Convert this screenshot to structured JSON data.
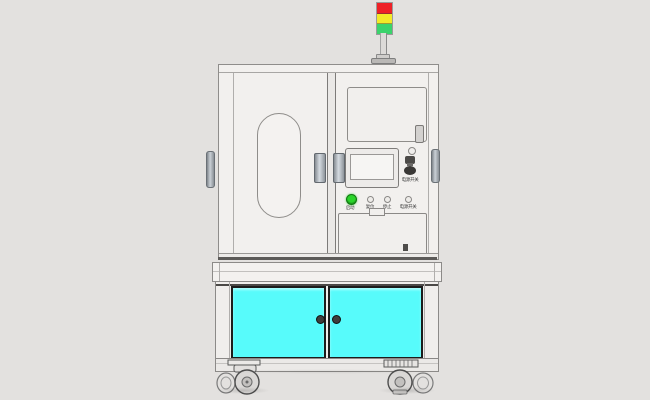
{
  "scene": {
    "background_color": "#e3e1df",
    "body_color": "#f2f0ee",
    "outline_color": "#8f8d8b"
  },
  "tower_light": {
    "segments": [
      {
        "name": "red-lamp",
        "color": "#ee2127"
      },
      {
        "name": "yellow-lamp",
        "color": "#f3ea27"
      },
      {
        "name": "green-lamp",
        "color": "#3bd36c"
      }
    ]
  },
  "control_panel": {
    "estop_label": "电源开关",
    "buttons": [
      {
        "label": "启动",
        "color": "#2ad42a"
      },
      {
        "label": "复位",
        "color": "#eeece9"
      },
      {
        "label": "停止",
        "color": "#eeece9"
      },
      {
        "label": "电源开关",
        "color": "#eeece9"
      }
    ]
  },
  "lower_cabinet": {
    "door_color": "#57fbfb"
  }
}
